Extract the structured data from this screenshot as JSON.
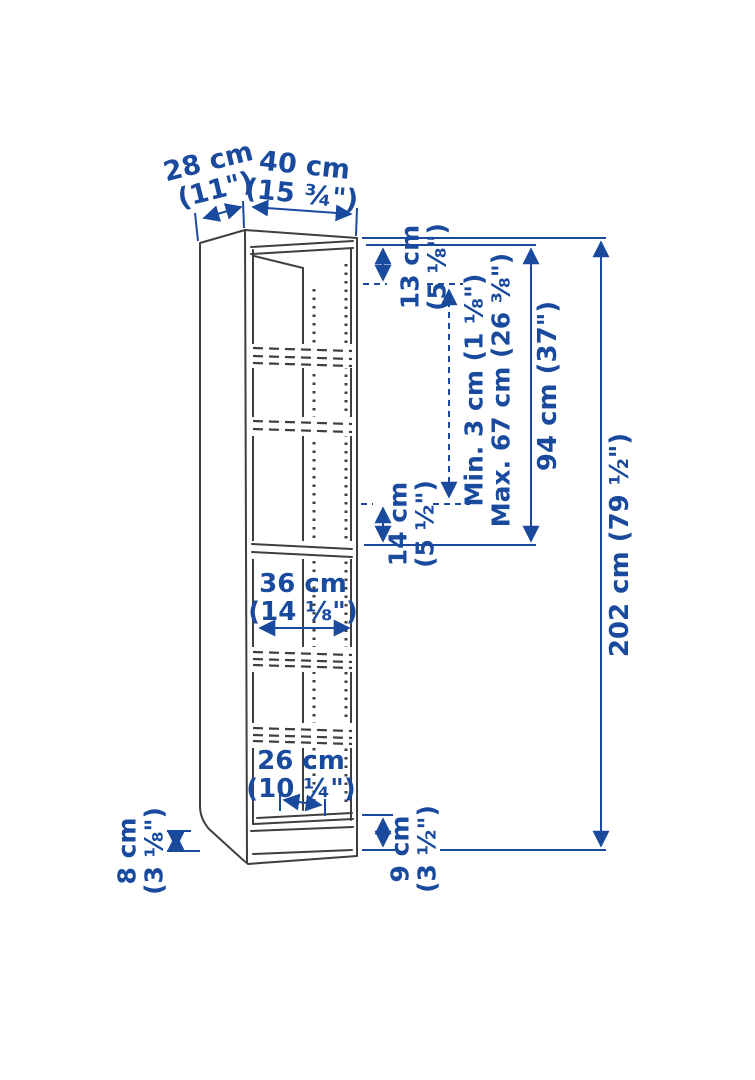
{
  "diagram": {
    "title": "bookcase-dimension-diagram",
    "accent_color": "#1a4a9e",
    "outline_color": "#3f3f3f",
    "labels": {
      "depth": {
        "line1": "28 cm",
        "line2": "(11\")"
      },
      "width": {
        "line1": "40 cm",
        "line2": "(15 ¾\")"
      },
      "top_gap": {
        "line1": "13 cm",
        "line2": "(5 ⅛\")"
      },
      "shelf_range": {
        "line1": "Min. 3 cm (1 ⅛\")",
        "line2": "Max. 67 cm (26 ⅜\")"
      },
      "upper_section": "94 cm (37\")",
      "total_height": "202 cm (79 ½\")",
      "above_fixed_shelf": {
        "line1": "14 cm",
        "line2": "(5 ½\")"
      },
      "inner_width": {
        "line1": "36 cm",
        "line2": "(14 ⅛\")"
      },
      "inner_depth": {
        "line1": "26 cm",
        "line2": "(10 ¼\")"
      },
      "plinth_front": {
        "line1": "9 cm",
        "line2": "(3 ½\")"
      },
      "plinth_side": {
        "line1": "8 cm",
        "line2": "(3 ⅛\")"
      }
    }
  }
}
